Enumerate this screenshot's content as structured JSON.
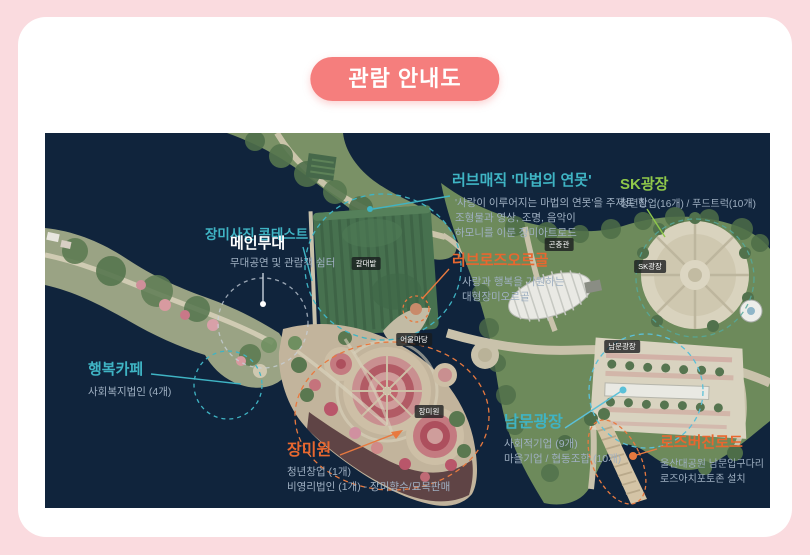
{
  "title": "관람 안내도",
  "colors": {
    "page_bg": "#fadbdf",
    "card_bg": "#ffffff",
    "title_badge_bg": "#f57e7d",
    "map_bg": "#10243c",
    "teal": "#3fb4c4",
    "green": "#8fc84a",
    "orange": "#e8672f",
    "light_blue": "#5bc0d8",
    "sub_text": "#9fb0c2"
  },
  "map": {
    "badges": [
      {
        "label": "곤충관"
      },
      {
        "label": "SK광장"
      },
      {
        "label": "갈대밭"
      },
      {
        "label": "어울마당"
      },
      {
        "label": "장미원"
      },
      {
        "label": "남문광장"
      }
    ],
    "annotations": [
      {
        "id": "rose-photo-contest",
        "title": "장미사진 콘테스트",
        "lines": []
      },
      {
        "id": "main-stage",
        "title": "메인무대",
        "lines": [
          "무대공연 및 관람객 쉼터"
        ]
      },
      {
        "id": "love-magic-pond",
        "title": "러브매직 '마법의 연못'",
        "lines": [
          "'사랑이 이루어지는 마법의 연못'을 주제로 한",
          "조형물과 영상, 조명, 음악이",
          "하모니를 이룬 장미아트로드"
        ]
      },
      {
        "id": "sk-plaza",
        "title": "SK광장",
        "lines": [
          "청년창업(16개) / 푸드트럭(10개)"
        ]
      },
      {
        "id": "love-rose-orgel",
        "title": "러브로즈오르골",
        "lines": [
          "사랑과 행복을 기원하는",
          "대형장미오르골"
        ]
      },
      {
        "id": "happy-cafe",
        "title": "행복카페",
        "lines": [
          "사회복지법인 (4개)"
        ]
      },
      {
        "id": "rose-garden",
        "title": "장미원",
        "lines": [
          "청년창업 (1개)",
          "비영리법인 (1개) - 장미향수/묘목판매"
        ]
      },
      {
        "id": "south-gate-plaza",
        "title": "남문광장",
        "lines": [
          "사회적기업 (9개)",
          "마을기업 / 협동조합 (10개)"
        ]
      },
      {
        "id": "rose-virgin-road",
        "title": "로즈버진로드",
        "lines": [
          "울산대공원 남문입구다리",
          "로즈아치포토존 설치"
        ]
      }
    ]
  }
}
